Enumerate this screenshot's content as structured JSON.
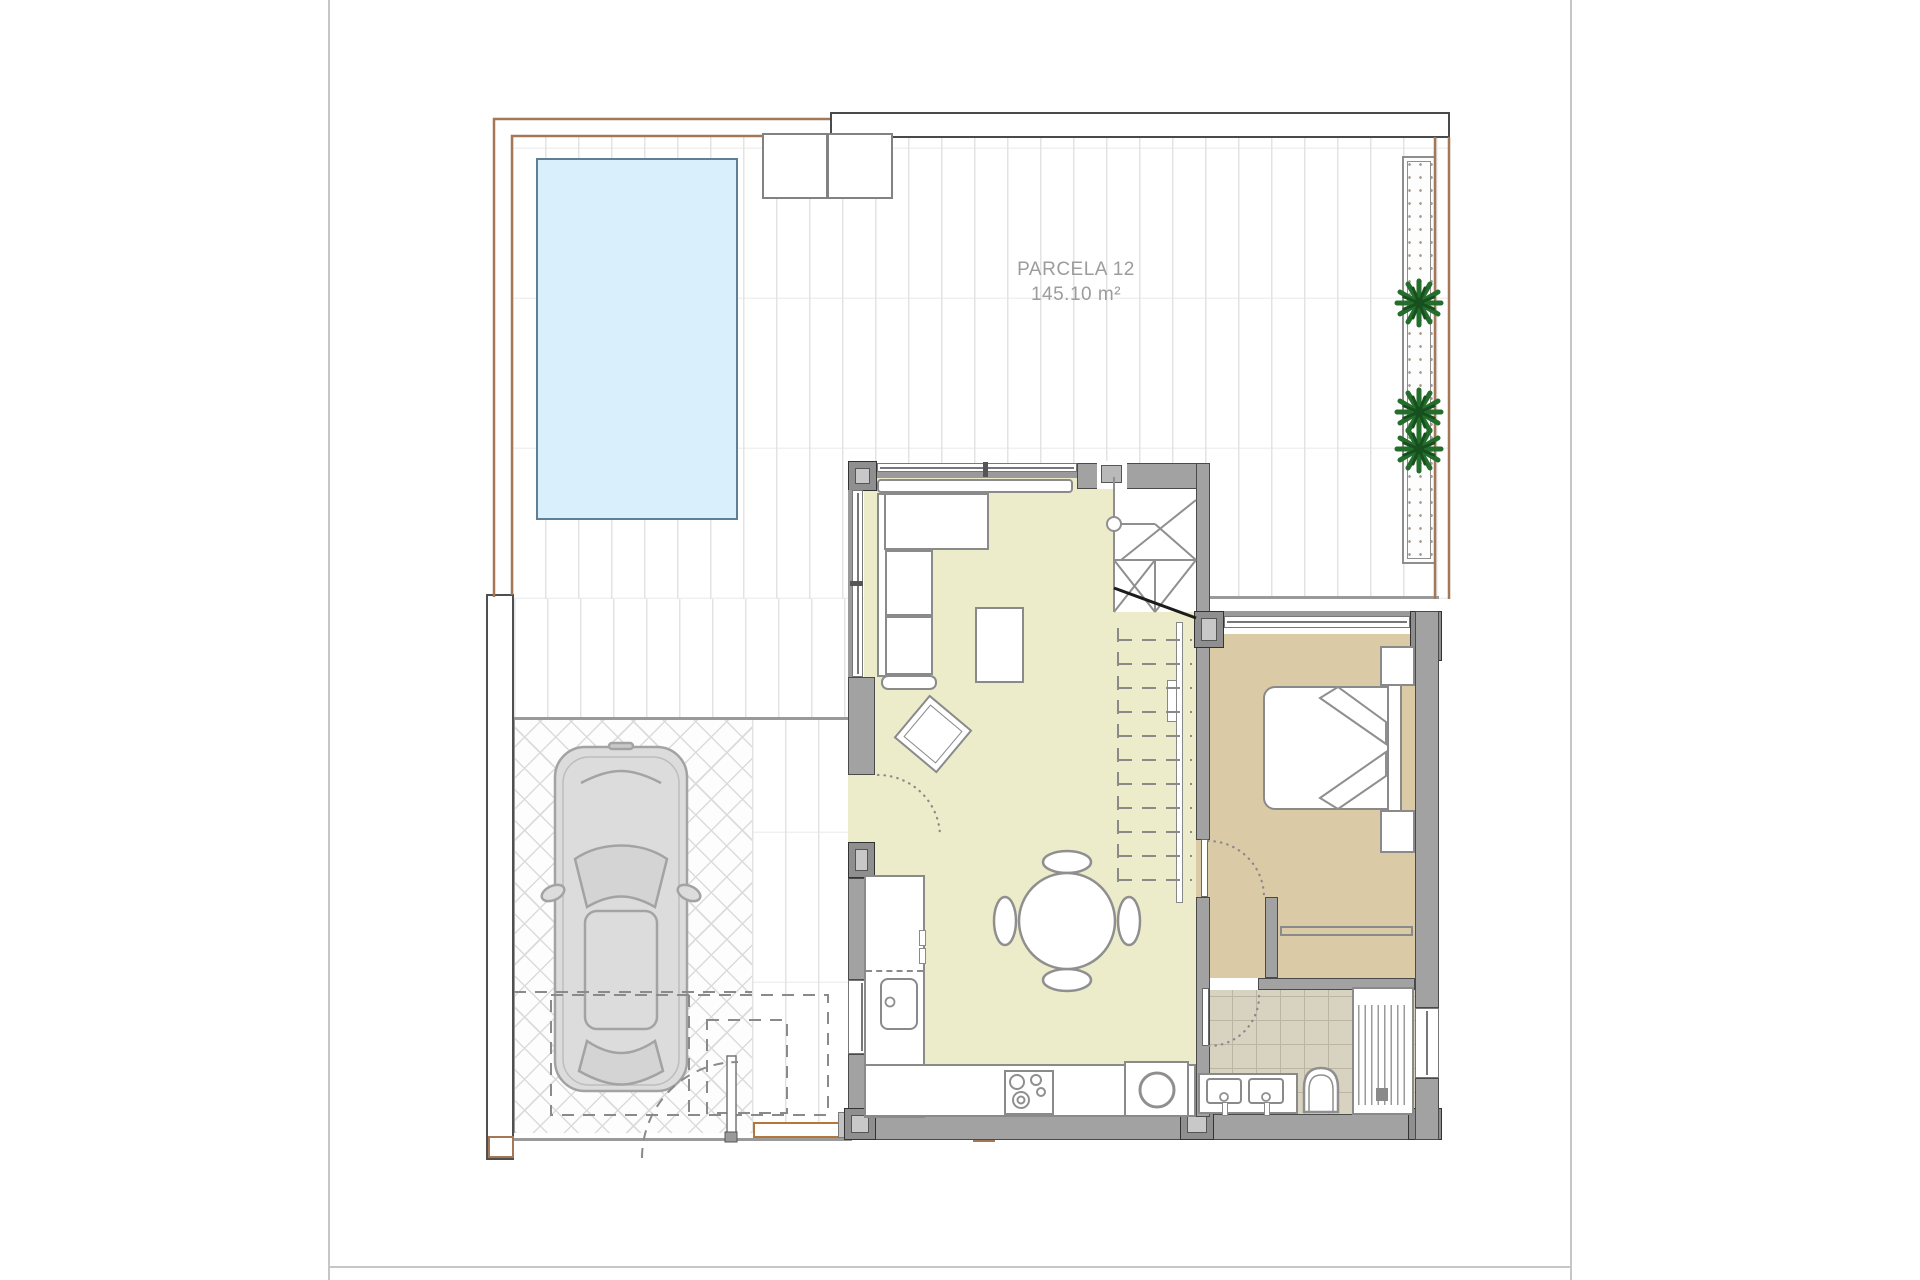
{
  "plan": {
    "parcel_label": "PARCELA 12",
    "area_label": "145.10 m²"
  },
  "colors": {
    "boundary_brown": "#a47856",
    "pool_fill": "#d9effb",
    "pool_border": "#5e8096",
    "living_floor": "#edecca",
    "bedroom_floor": "#dbcaa6",
    "bathroom_tile": "#d8d2c1",
    "wall_fill": "#a2a2a2",
    "wall_outline": "#4a4a4a",
    "furniture_outline": "#8a8a8a",
    "stair_cut_line": "#1c1c1c",
    "plant_green": "#246e2c",
    "plant_green_dark": "#174f1e",
    "entry_step_accent": "#b5763a",
    "car_body": "#dcdcdc",
    "deck_line": "#e3e3e3",
    "label_text": "#9c9c9c"
  },
  "icons": {
    "plant": "plant-icon",
    "car": "car-top-view-icon",
    "toilet": "toilet-icon",
    "shower": "shower-icon",
    "sink": "sink-icon",
    "cooktop": "cooktop-icon",
    "washer": "washing-machine-icon",
    "bed": "double-bed-icon",
    "sofa": "corner-sofa-icon",
    "stairs": "staircase-icon",
    "pool": "swimming-pool-icon"
  }
}
